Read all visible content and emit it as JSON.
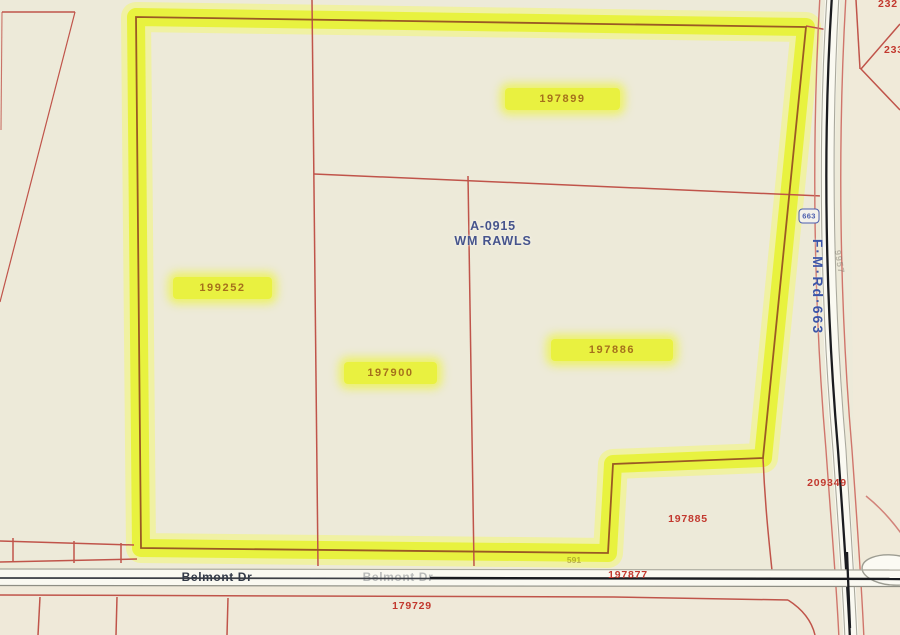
{
  "colors": {
    "background": "#edead9",
    "highlight_yellow": "#e7f13a",
    "parcel_line_red": "#c0544a",
    "parcel_text_red": "#c2382e",
    "highlight_text_brown": "#a5701c",
    "abstract_blue": "#46548c",
    "road_label_blue": "#3c55a8",
    "road_surface": "#faf9f1"
  },
  "abstract": {
    "id": "A-0915",
    "name": "WM RAWLS"
  },
  "highlighted_parcels": {
    "p197899": "197899",
    "p199252": "199252",
    "p197900": "197900",
    "p197886": "197886"
  },
  "parcels": {
    "p197885": "197885",
    "p197877": "197877",
    "p179729": "179729",
    "p209349": "209349",
    "p232_partial": "232",
    "p233_partial": "233",
    "p591": "591"
  },
  "roads": {
    "fm_road_label": "F·M·Rd·663",
    "fm_shield": "663",
    "belmont": "Belmont Dr",
    "belmont_ghost": "Belmont Dr",
    "faded_number": "9957"
  }
}
